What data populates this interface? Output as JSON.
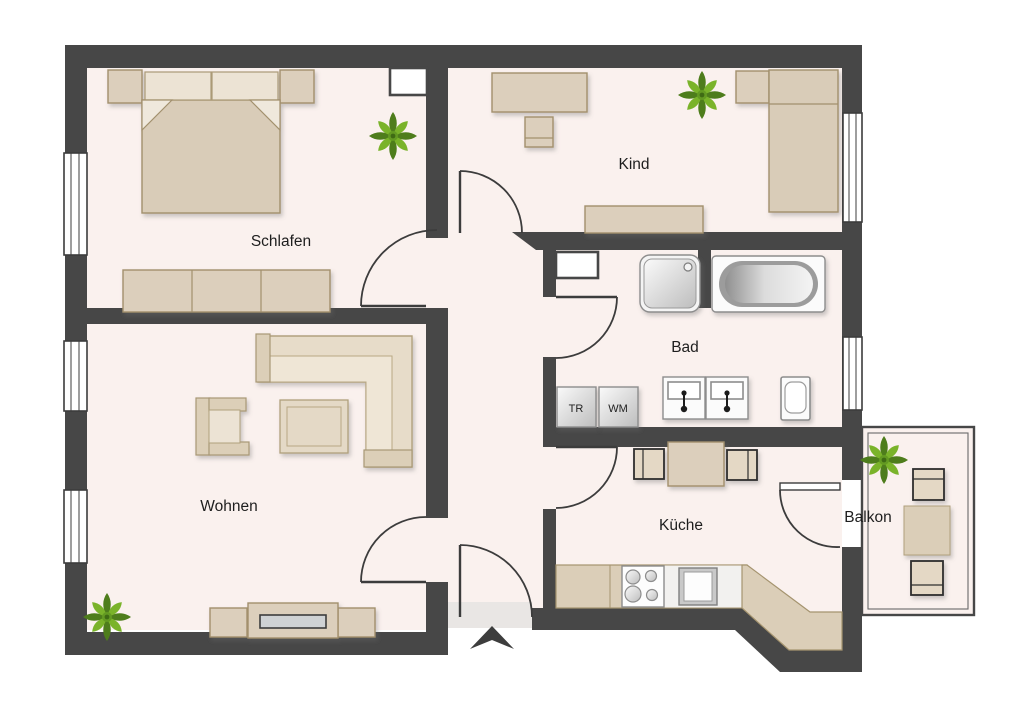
{
  "floorplan": {
    "title": "Apartment floor plan",
    "rooms": [
      {
        "id": "schlafen",
        "label": "Schlafen"
      },
      {
        "id": "kind",
        "label": "Kind"
      },
      {
        "id": "bad",
        "label": "Bad"
      },
      {
        "id": "wohnen",
        "label": "Wohnen"
      },
      {
        "id": "kueche",
        "label": "Küche"
      },
      {
        "id": "balkon",
        "label": "Balkon"
      }
    ],
    "appliances": {
      "dryer_label": "TR",
      "washer_label": "WM"
    },
    "colors": {
      "wall": "#474747",
      "floor": "#faf1ee",
      "furniture": "#dccfbc",
      "furniture_border": "#a2906d",
      "plant_green_dark": "#4e7d1c",
      "plant_green_light": "#7ab32a",
      "outside": "#ffffff"
    }
  }
}
